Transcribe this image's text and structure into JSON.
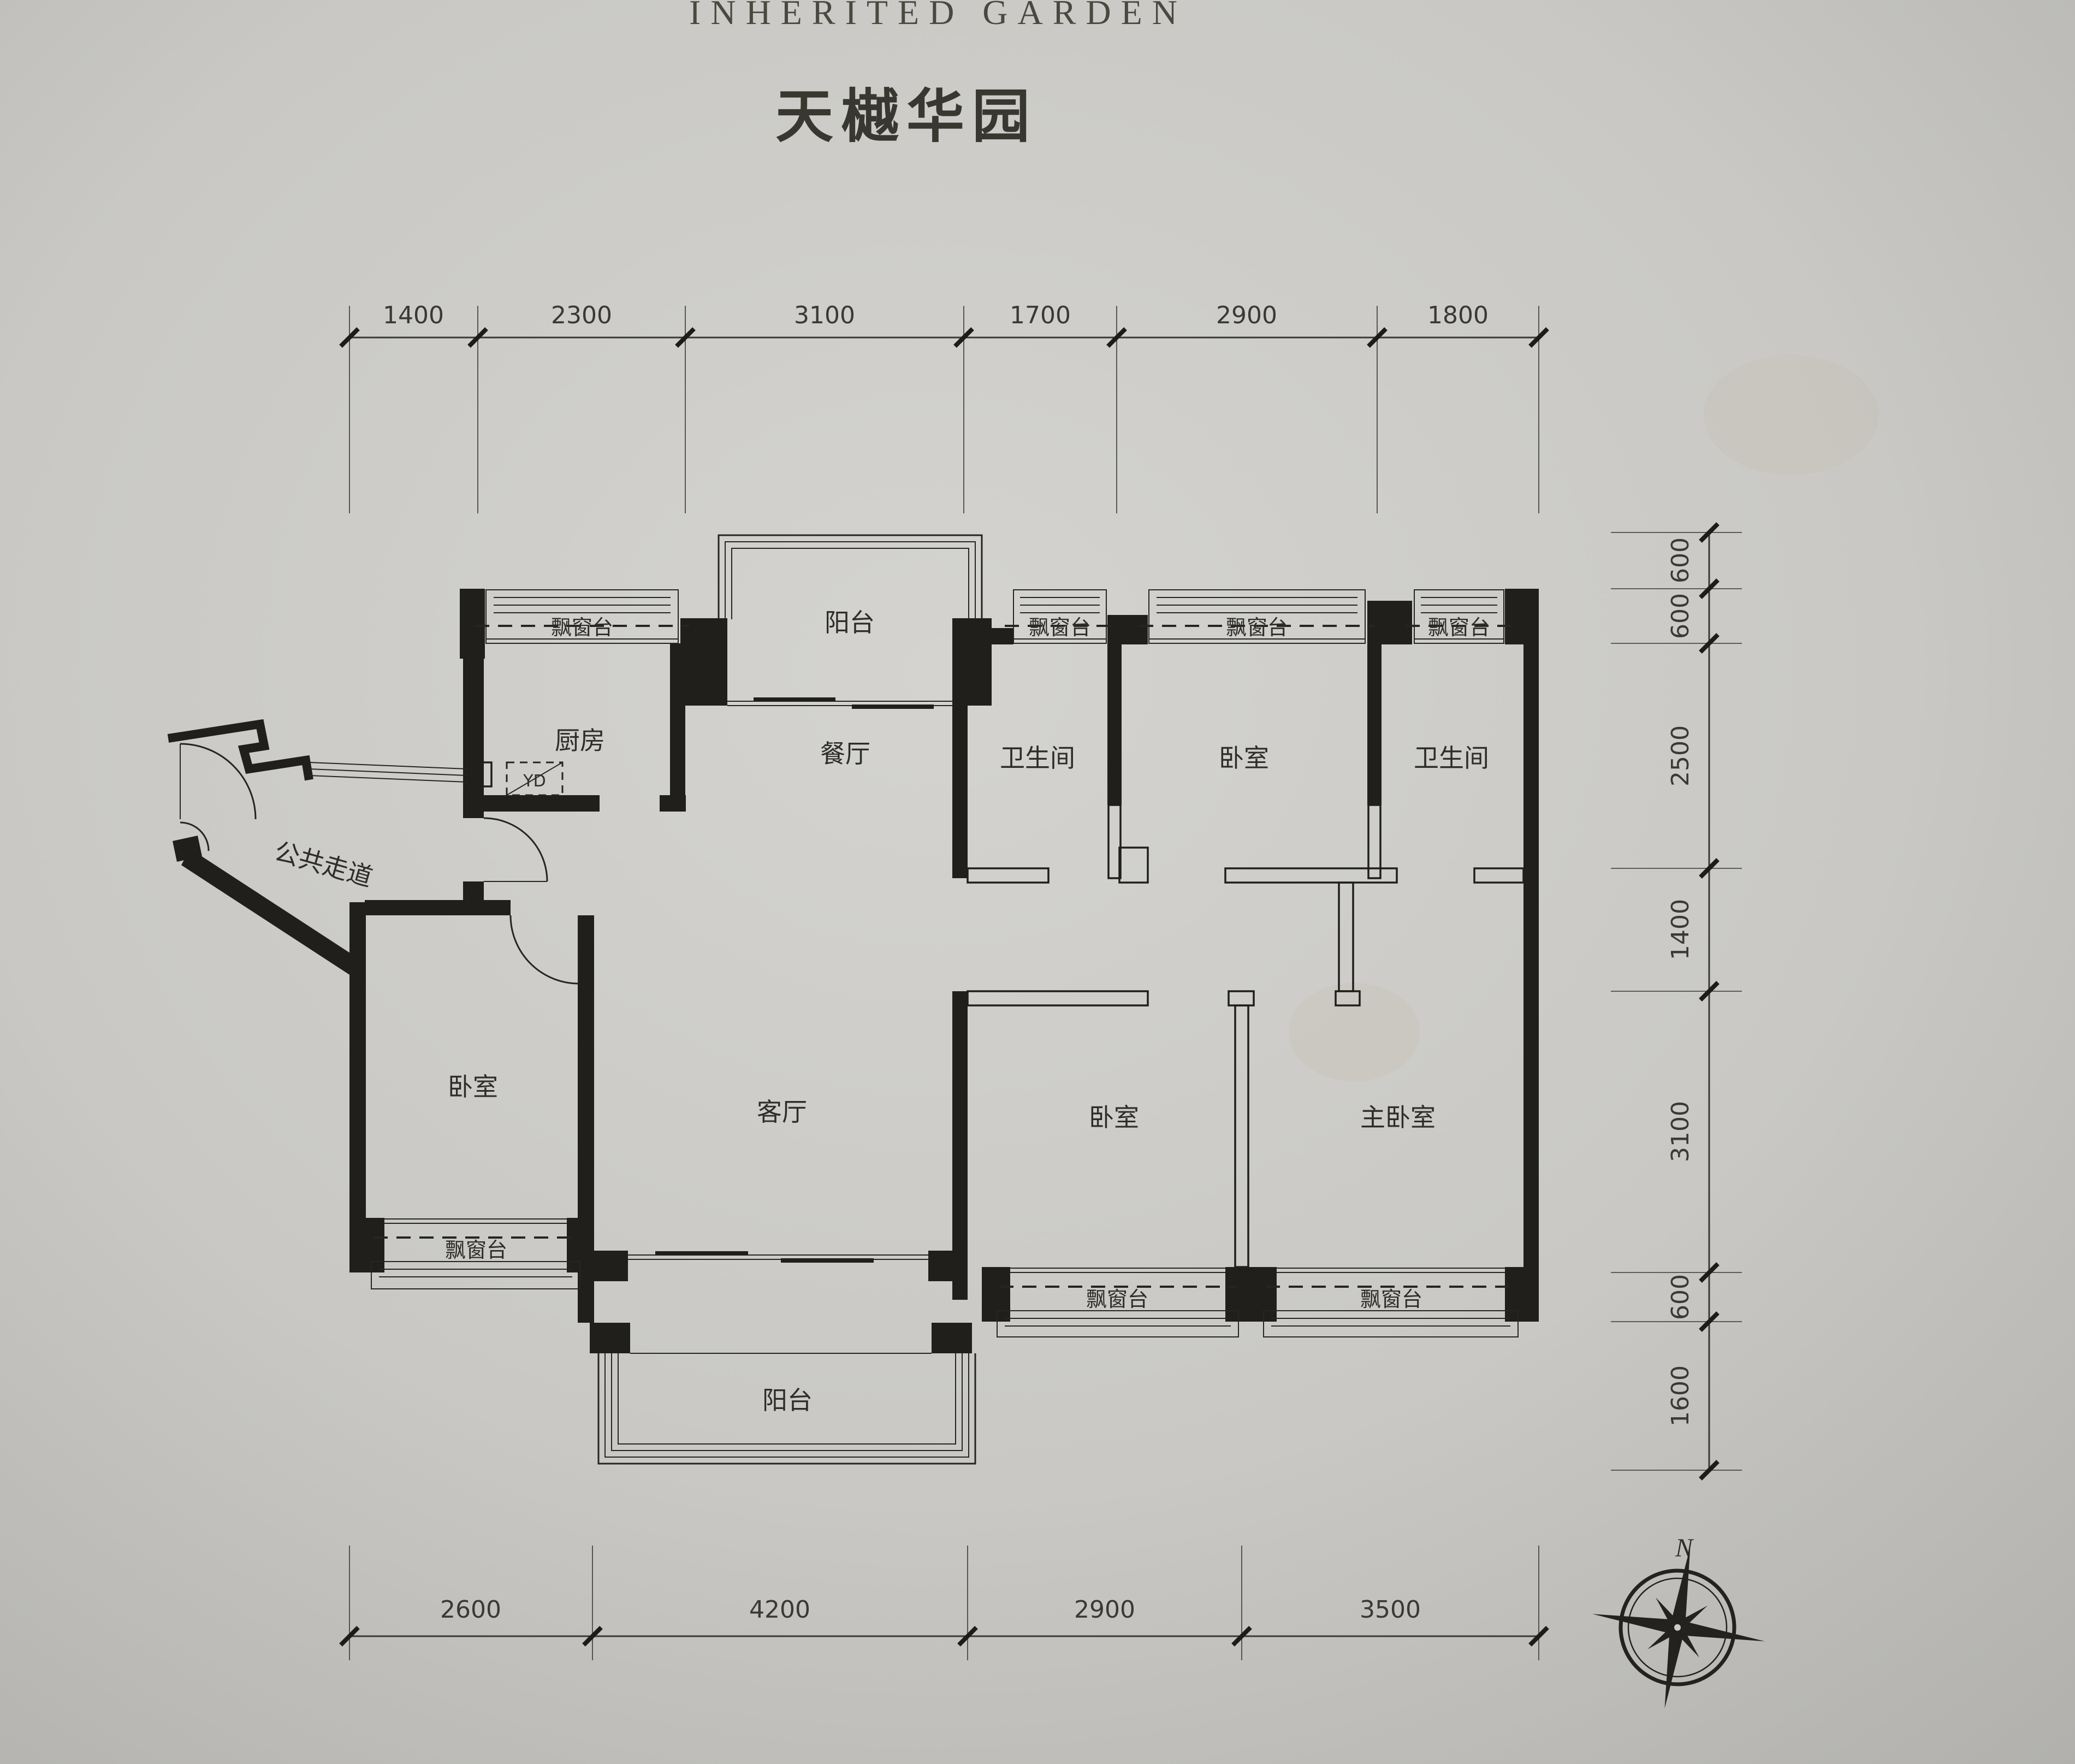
{
  "title": {
    "en": "INHERITED GARDEN",
    "zh": "天樾华园"
  },
  "compass": {
    "north": "N"
  },
  "meter_box": {
    "label": "YD"
  },
  "rooms": [
    {
      "id": "balcony-top",
      "label": "阳台"
    },
    {
      "id": "kitchen",
      "label": "厨房"
    },
    {
      "id": "dining-room",
      "label": "餐厅"
    },
    {
      "id": "bathroom-1",
      "label": "卫生间"
    },
    {
      "id": "bedroom-top",
      "label": "卧室"
    },
    {
      "id": "bathroom-2",
      "label": "卫生间"
    },
    {
      "id": "public-corridor",
      "label": "公共走道"
    },
    {
      "id": "bedroom-left",
      "label": "卧室"
    },
    {
      "id": "living-room",
      "label": "客厅"
    },
    {
      "id": "bedroom-bottom",
      "label": "卧室"
    },
    {
      "id": "master-bedroom",
      "label": "主卧室"
    },
    {
      "id": "balcony-bottom",
      "label": "阳台"
    }
  ],
  "bay_windows": [
    {
      "id": "kitchen-bay",
      "label": "飘窗台"
    },
    {
      "id": "bathroom-1-bay",
      "label": "飘窗台"
    },
    {
      "id": "bedroom-top-bay",
      "label": "飘窗台"
    },
    {
      "id": "bathroom-2-bay",
      "label": "飘窗台"
    },
    {
      "id": "bedroom-left-bay",
      "label": "飘窗台"
    },
    {
      "id": "bedroom-bottom-bay",
      "label": "飘窗台"
    },
    {
      "id": "master-bay",
      "label": "飘窗台"
    }
  ],
  "dimensions": {
    "top": [
      "1400",
      "2300",
      "3100",
      "1700",
      "2900",
      "1800"
    ],
    "bottom": [
      "2600",
      "4200",
      "2900",
      "3500"
    ],
    "right": [
      "600",
      "600",
      "2500",
      "1400",
      "3100",
      "600",
      "1600"
    ]
  },
  "colors": {
    "paper": "#cccbc7",
    "ink": "#201f1c"
  }
}
